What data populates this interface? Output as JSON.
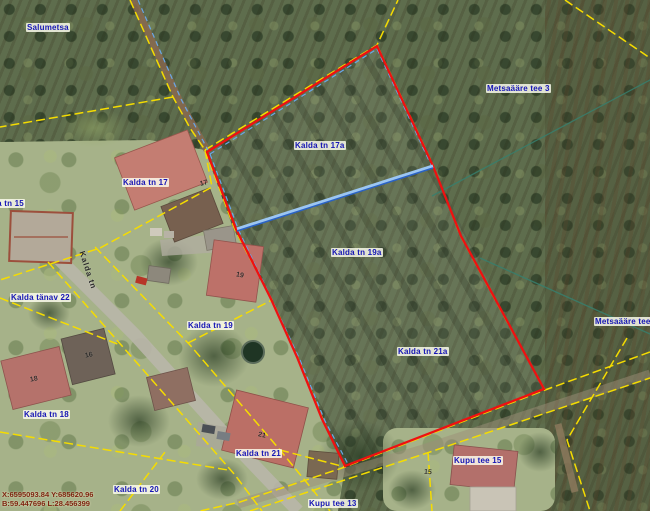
{
  "map": {
    "coordinates": {
      "line1": "X:6595093.84 Y:685620.96",
      "line2": "B:59.447696 L:28.456399"
    },
    "street_label": {
      "text": "Kalda tn",
      "x": 86,
      "y": 250,
      "rotation": 72
    },
    "parcel_labels": [
      {
        "text": "Salumetsa",
        "x": 26,
        "y": 23
      },
      {
        "text": "Kalda tn 15",
        "x": -22,
        "y": 199
      },
      {
        "text": "Kalda tn 17",
        "x": 122,
        "y": 178
      },
      {
        "text": "Kalda tn 17a",
        "x": 294,
        "y": 141
      },
      {
        "text": "Kalda tn 19a",
        "x": 331,
        "y": 248
      },
      {
        "text": "Kalda tn 21a",
        "x": 397,
        "y": 347
      },
      {
        "text": "Kalda tn 19",
        "x": 187,
        "y": 321
      },
      {
        "text": "Kalda tänav 22",
        "x": 10,
        "y": 293
      },
      {
        "text": "Kalda tn 18",
        "x": 23,
        "y": 410
      },
      {
        "text": "Kalda tn 21",
        "x": 235,
        "y": 449
      },
      {
        "text": "Kalda tn 20",
        "x": 113,
        "y": 485
      },
      {
        "text": "Kupu tee 15",
        "x": 453,
        "y": 456
      },
      {
        "text": "Kupu tee 13",
        "x": 308,
        "y": 499
      },
      {
        "text": "Metsaääre tee 3",
        "x": 486,
        "y": 84
      },
      {
        "text": "Metsaääre tee 1",
        "x": 594,
        "y": 317
      }
    ],
    "house_numbers": [
      {
        "text": "17",
        "x": 200,
        "y": 180,
        "rot": -15
      },
      {
        "text": "19",
        "x": 236,
        "y": 272,
        "rot": 10
      },
      {
        "text": "16",
        "x": 85,
        "y": 352,
        "rot": -12
      },
      {
        "text": "18",
        "x": 30,
        "y": 376,
        "rot": -12
      },
      {
        "text": "21",
        "x": 258,
        "y": 432,
        "rot": 12
      },
      {
        "text": "15",
        "x": 424,
        "y": 469,
        "rot": 5
      }
    ],
    "colors": {
      "cadastral_boundary": "#f5dc00",
      "selected_parcel": "#ee1111",
      "division_line_light": "#9cc6f2",
      "division_line_dark": "#2a62c4",
      "blue_dashed": "#69a7e8",
      "zone_line": "#377f6d"
    }
  }
}
